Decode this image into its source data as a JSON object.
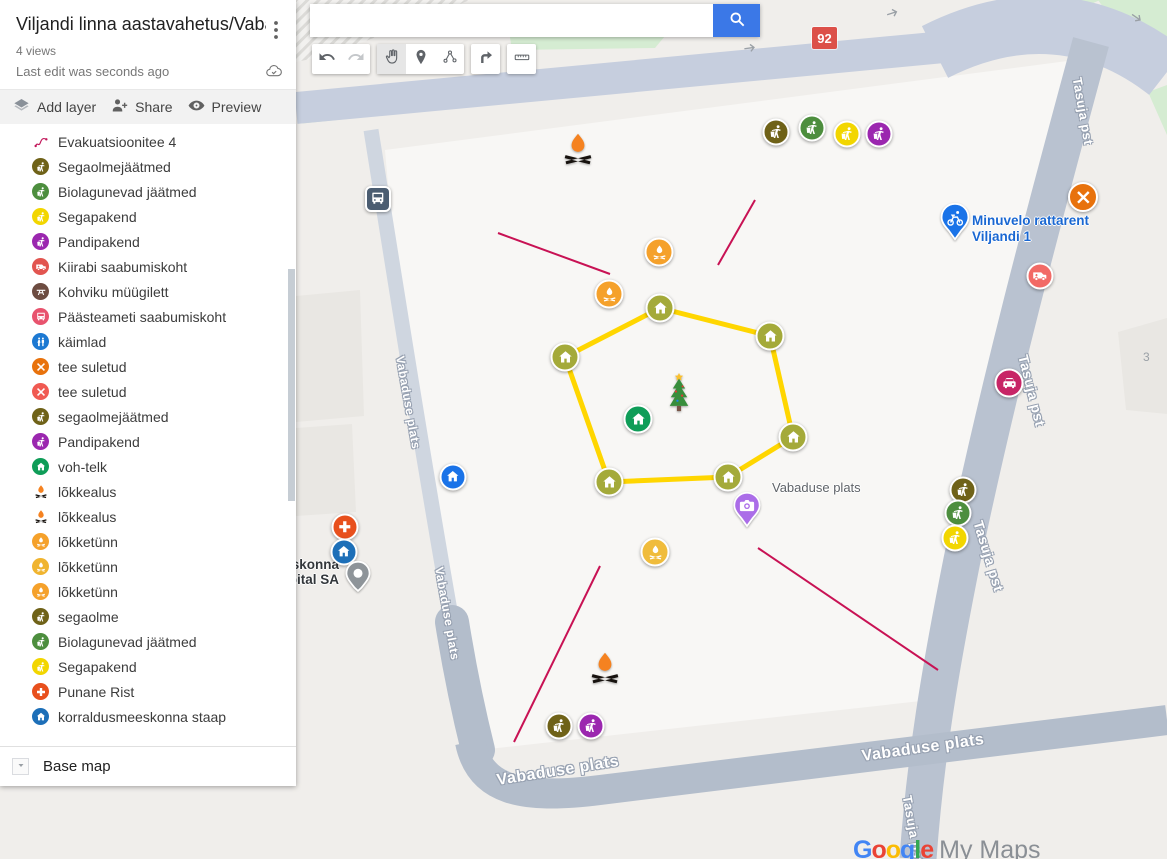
{
  "panel": {
    "title": "Viljandi linna aastavahetus/Vaba...",
    "views": "4 views",
    "last_edit": "Last edit was seconds ago",
    "toolbar": {
      "add_layer": "Add layer",
      "share": "Share",
      "preview": "Preview"
    },
    "base_map": "Base map",
    "items": [
      {
        "label": "Evakuatsioonitee 4",
        "icon": "route-zigzag",
        "color": "",
        "nobg": true
      },
      {
        "label": "Segaolmejäätmed",
        "icon": "litter",
        "color": "#6f6218"
      },
      {
        "label": "Biolagunevad jäätmed",
        "icon": "litter",
        "color": "#4d8e3e"
      },
      {
        "label": "Segapakend",
        "icon": "litter",
        "color": "#f2d600"
      },
      {
        "label": "Pandipakend",
        "icon": "litter",
        "color": "#9b27af"
      },
      {
        "label": "Kiirabi saabumiskoht",
        "icon": "ambulance",
        "color": "#e25550"
      },
      {
        "label": "Kohviku müügilett",
        "icon": "picnic",
        "color": "#6d4c41"
      },
      {
        "label": "Päästeameti saabumiskoht",
        "icon": "bus",
        "color": "#e8536e"
      },
      {
        "label": "käimlad",
        "icon": "restroom",
        "color": "#1d79d2"
      },
      {
        "label": "tee suletud",
        "icon": "x-mark",
        "color": "#e8720c"
      },
      {
        "label": "tee suletud",
        "icon": "x-mark",
        "color": "#f05a52"
      },
      {
        "label": "segaolmejäätmed",
        "icon": "litter",
        "color": "#6f6218"
      },
      {
        "label": "Pandipakend",
        "icon": "litter",
        "color": "#9b27af"
      },
      {
        "label": "voh-telk",
        "icon": "home",
        "color": "#0f9d58"
      },
      {
        "label": "lõkkealus",
        "icon": "bonfire",
        "color": "",
        "nobg": true
      },
      {
        "label": "lõkkealus",
        "icon": "bonfire",
        "color": "",
        "nobg": true
      },
      {
        "label": "lõkketünn",
        "icon": "campfire",
        "color": "#f5a12b"
      },
      {
        "label": "lõkketünn",
        "icon": "campfire",
        "color": "#f0b42f"
      },
      {
        "label": "lõkketünn",
        "icon": "campfire",
        "color": "#f5a12b"
      },
      {
        "label": "segaolme",
        "icon": "litter",
        "color": "#6f6218"
      },
      {
        "label": "Biolagunevad jäätmed",
        "icon": "litter",
        "color": "#4d8e3e"
      },
      {
        "label": "Segapakend",
        "icon": "litter",
        "color": "#f2d600"
      },
      {
        "label": "Punane Rist",
        "icon": "plus",
        "color": "#e8501d"
      },
      {
        "label": "korraldusmeeskonna staap",
        "icon": "home",
        "color": "#1d6fb8"
      }
    ]
  },
  "map": {
    "search": {
      "value": "",
      "placeholder": ""
    },
    "route_badge": "92",
    "building_number": "3",
    "area_label": {
      "text": "Vabaduse plats",
      "x": 772,
      "y": 480
    },
    "place_label": {
      "line1": "Minuvelo rattarent",
      "line2": "Viljandi 1",
      "x": 972,
      "y": 213
    },
    "hospital_label": {
      "line1": "iskonna",
      "line2": "pital SA",
      "right": 339,
      "y": 557
    },
    "street_labels": [
      {
        "text": "Vabaduse plats",
        "x": 400,
        "y": 349,
        "rot": 80,
        "size": 12
      },
      {
        "text": "Vabaduse plats",
        "x": 439,
        "y": 560,
        "rot": 80,
        "size": 12
      },
      {
        "text": "Vabaduse plats",
        "x": 497,
        "y": 772,
        "rot": -9,
        "size": 16
      },
      {
        "text": "Vabaduse plats",
        "x": 862,
        "y": 748,
        "rot": -8,
        "size": 16
      },
      {
        "text": "Tasuja pst",
        "x": 1077,
        "y": 70,
        "rot": 80,
        "size": 13
      },
      {
        "text": "Tasuja pst",
        "x": 1023,
        "y": 347,
        "rot": 76,
        "size": 14
      },
      {
        "text": "Tasuja pst",
        "x": 978,
        "y": 513,
        "rot": 73,
        "size": 14
      },
      {
        "text": "Tasuja pst",
        "x": 907,
        "y": 788,
        "rot": 80,
        "size": 13
      }
    ],
    "arrows": [
      {
        "x": 750,
        "y": 48,
        "rot": -8
      },
      {
        "x": 893,
        "y": 13,
        "rot": -18
      },
      {
        "x": 1135,
        "y": 17,
        "rot": 35
      }
    ],
    "polygon": {
      "stroke": "#ffd600",
      "points": [
        [
          660,
          308
        ],
        [
          770,
          336
        ],
        [
          793,
          437
        ],
        [
          728,
          477
        ],
        [
          609,
          482
        ],
        [
          565,
          357
        ]
      ],
      "vertex_icon": "home",
      "vertex_color": "#a4aa3a",
      "vertex_size": 29
    },
    "evac_lines": {
      "color": "#c81254",
      "segments": [
        [
          498,
          233,
          610,
          274
        ],
        [
          718,
          265,
          755,
          200
        ],
        [
          600,
          566,
          514,
          742
        ],
        [
          758,
          548,
          938,
          670
        ]
      ]
    },
    "markers": [
      {
        "name": "bus-stop-marker",
        "icon": "bus",
        "shape": "square",
        "color": "#4b5d71",
        "x": 378,
        "y": 199,
        "size": 26
      },
      {
        "name": "bonfire-marker-1",
        "icon": "bonfire",
        "shape": "plain",
        "color": "",
        "x": 578,
        "y": 150,
        "size": 38
      },
      {
        "name": "waste-mixed-marker-1",
        "icon": "litter",
        "shape": "circle",
        "color": "#6f6218",
        "x": 776,
        "y": 132,
        "size": 27
      },
      {
        "name": "waste-bio-marker-1",
        "icon": "litter",
        "shape": "circle",
        "color": "#4d8e3e",
        "x": 812,
        "y": 128,
        "size": 27
      },
      {
        "name": "waste-packaging-marker-1",
        "icon": "litter",
        "shape": "circle",
        "color": "#f2d600",
        "x": 847,
        "y": 134,
        "size": 27
      },
      {
        "name": "waste-deposit-marker-1",
        "icon": "litter",
        "shape": "circle",
        "color": "#9b27af",
        "x": 879,
        "y": 134,
        "size": 27
      },
      {
        "name": "road-closed-marker",
        "icon": "x-mark",
        "shape": "circle",
        "color": "#e8720c",
        "x": 1083,
        "y": 197,
        "size": 30
      },
      {
        "name": "bike-rental-pin",
        "icon": "bike-pin",
        "shape": "plain",
        "color": "#1a73e8",
        "x": 955,
        "y": 222,
        "size": 34
      },
      {
        "name": "ambulance-marker",
        "icon": "ambulance",
        "shape": "circle",
        "color": "#f26a66",
        "x": 1040,
        "y": 276,
        "size": 27
      },
      {
        "name": "firebarrel-marker-1",
        "icon": "campfire",
        "shape": "circle",
        "color": "#f5a12b",
        "x": 659,
        "y": 252,
        "size": 29
      },
      {
        "name": "firebarrel-marker-2",
        "icon": "campfire",
        "shape": "circle",
        "color": "#f5a12b",
        "x": 609,
        "y": 294,
        "size": 29
      },
      {
        "name": "voh-telk-marker",
        "icon": "home",
        "shape": "circle",
        "color": "#0f9d58",
        "x": 638,
        "y": 419,
        "size": 29
      },
      {
        "name": "photo-pin",
        "icon": "camera-pin",
        "shape": "plain",
        "color": "#ab6de8",
        "x": 747,
        "y": 510,
        "size": 32
      },
      {
        "name": "firebarrel-marker-3",
        "icon": "campfire",
        "shape": "circle",
        "color": "#f0bc3c",
        "x": 655,
        "y": 552,
        "size": 29
      },
      {
        "name": "bonfire-marker-2",
        "icon": "bonfire",
        "shape": "plain",
        "color": "",
        "x": 605,
        "y": 669,
        "size": 38
      },
      {
        "name": "waste-mixed-marker-2",
        "icon": "litter",
        "shape": "circle",
        "color": "#6f6218",
        "x": 559,
        "y": 726,
        "size": 27
      },
      {
        "name": "waste-deposit-marker-2",
        "icon": "litter",
        "shape": "circle",
        "color": "#9b27af",
        "x": 591,
        "y": 726,
        "size": 27
      },
      {
        "name": "red-cross-marker",
        "icon": "plus",
        "shape": "circle",
        "color": "#e8501d",
        "x": 345,
        "y": 527,
        "size": 27
      },
      {
        "name": "hq-marker",
        "icon": "home",
        "shape": "circle",
        "color": "#1d6fb8",
        "x": 344,
        "y": 552,
        "size": 27
      },
      {
        "name": "hospital-poi-pin",
        "icon": "poi-pin",
        "shape": "plain",
        "color": "#8e9499",
        "x": 358,
        "y": 578,
        "size": 30
      },
      {
        "name": "toilets-marker",
        "icon": "home",
        "shape": "circle",
        "color": "#1a73e8",
        "x": 453,
        "y": 477,
        "size": 27
      },
      {
        "name": "waste-mixed-marker-3",
        "icon": "litter",
        "shape": "circle",
        "color": "#6f6218",
        "x": 963,
        "y": 490,
        "size": 27
      },
      {
        "name": "waste-bio-marker-2",
        "icon": "litter",
        "shape": "circle",
        "color": "#4d8e3e",
        "x": 958,
        "y": 513,
        "size": 27
      },
      {
        "name": "waste-packaging-marker-2",
        "icon": "litter",
        "shape": "circle",
        "color": "#f2d600",
        "x": 955,
        "y": 538,
        "size": 27
      },
      {
        "name": "rescue-car-marker",
        "icon": "car",
        "shape": "circle",
        "color": "#c72566",
        "x": 1009,
        "y": 383,
        "size": 29
      },
      {
        "name": "christmas-tree-marker",
        "icon": "tree",
        "shape": "plain",
        "color": "",
        "x": 679,
        "y": 394,
        "size": 36
      }
    ],
    "logo": {
      "letters": [
        "G",
        "o",
        "o",
        "g",
        "l",
        "e"
      ],
      "suffix": "My Maps"
    }
  }
}
